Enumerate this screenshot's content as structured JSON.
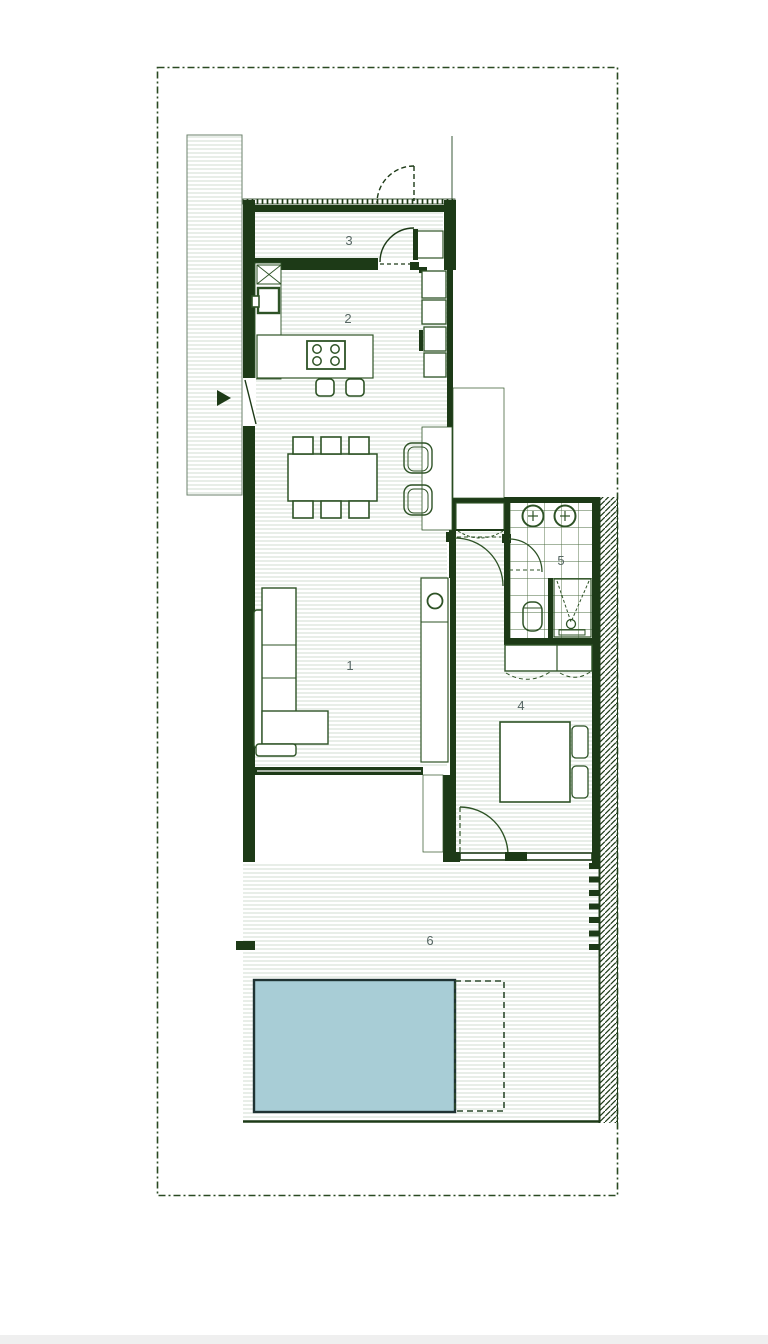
{
  "title": "residential floor plan with pool",
  "rooms": [
    {
      "id": "living-room",
      "number": "1"
    },
    {
      "id": "kitchen-dining",
      "number": "2"
    },
    {
      "id": "entry-storage",
      "number": "3"
    },
    {
      "id": "bedroom",
      "number": "4"
    },
    {
      "id": "bathroom",
      "number": "5"
    },
    {
      "id": "terrace",
      "number": "6"
    }
  ],
  "colors": {
    "page_bg": "#ffffff",
    "wall": "#1d3a17",
    "furniture": "#2e5326",
    "floor_stripe": "#dfe7df",
    "tile_line": "#4a6b3f",
    "hatch_line": "#1d3a17",
    "pool_fill": "#a8cdd6",
    "pool_border": "#1f3333",
    "label_text": "#566663",
    "boundary": "#2a4a22",
    "driveway_edge": "#6b826b",
    "footer_bar": "#efefef"
  }
}
